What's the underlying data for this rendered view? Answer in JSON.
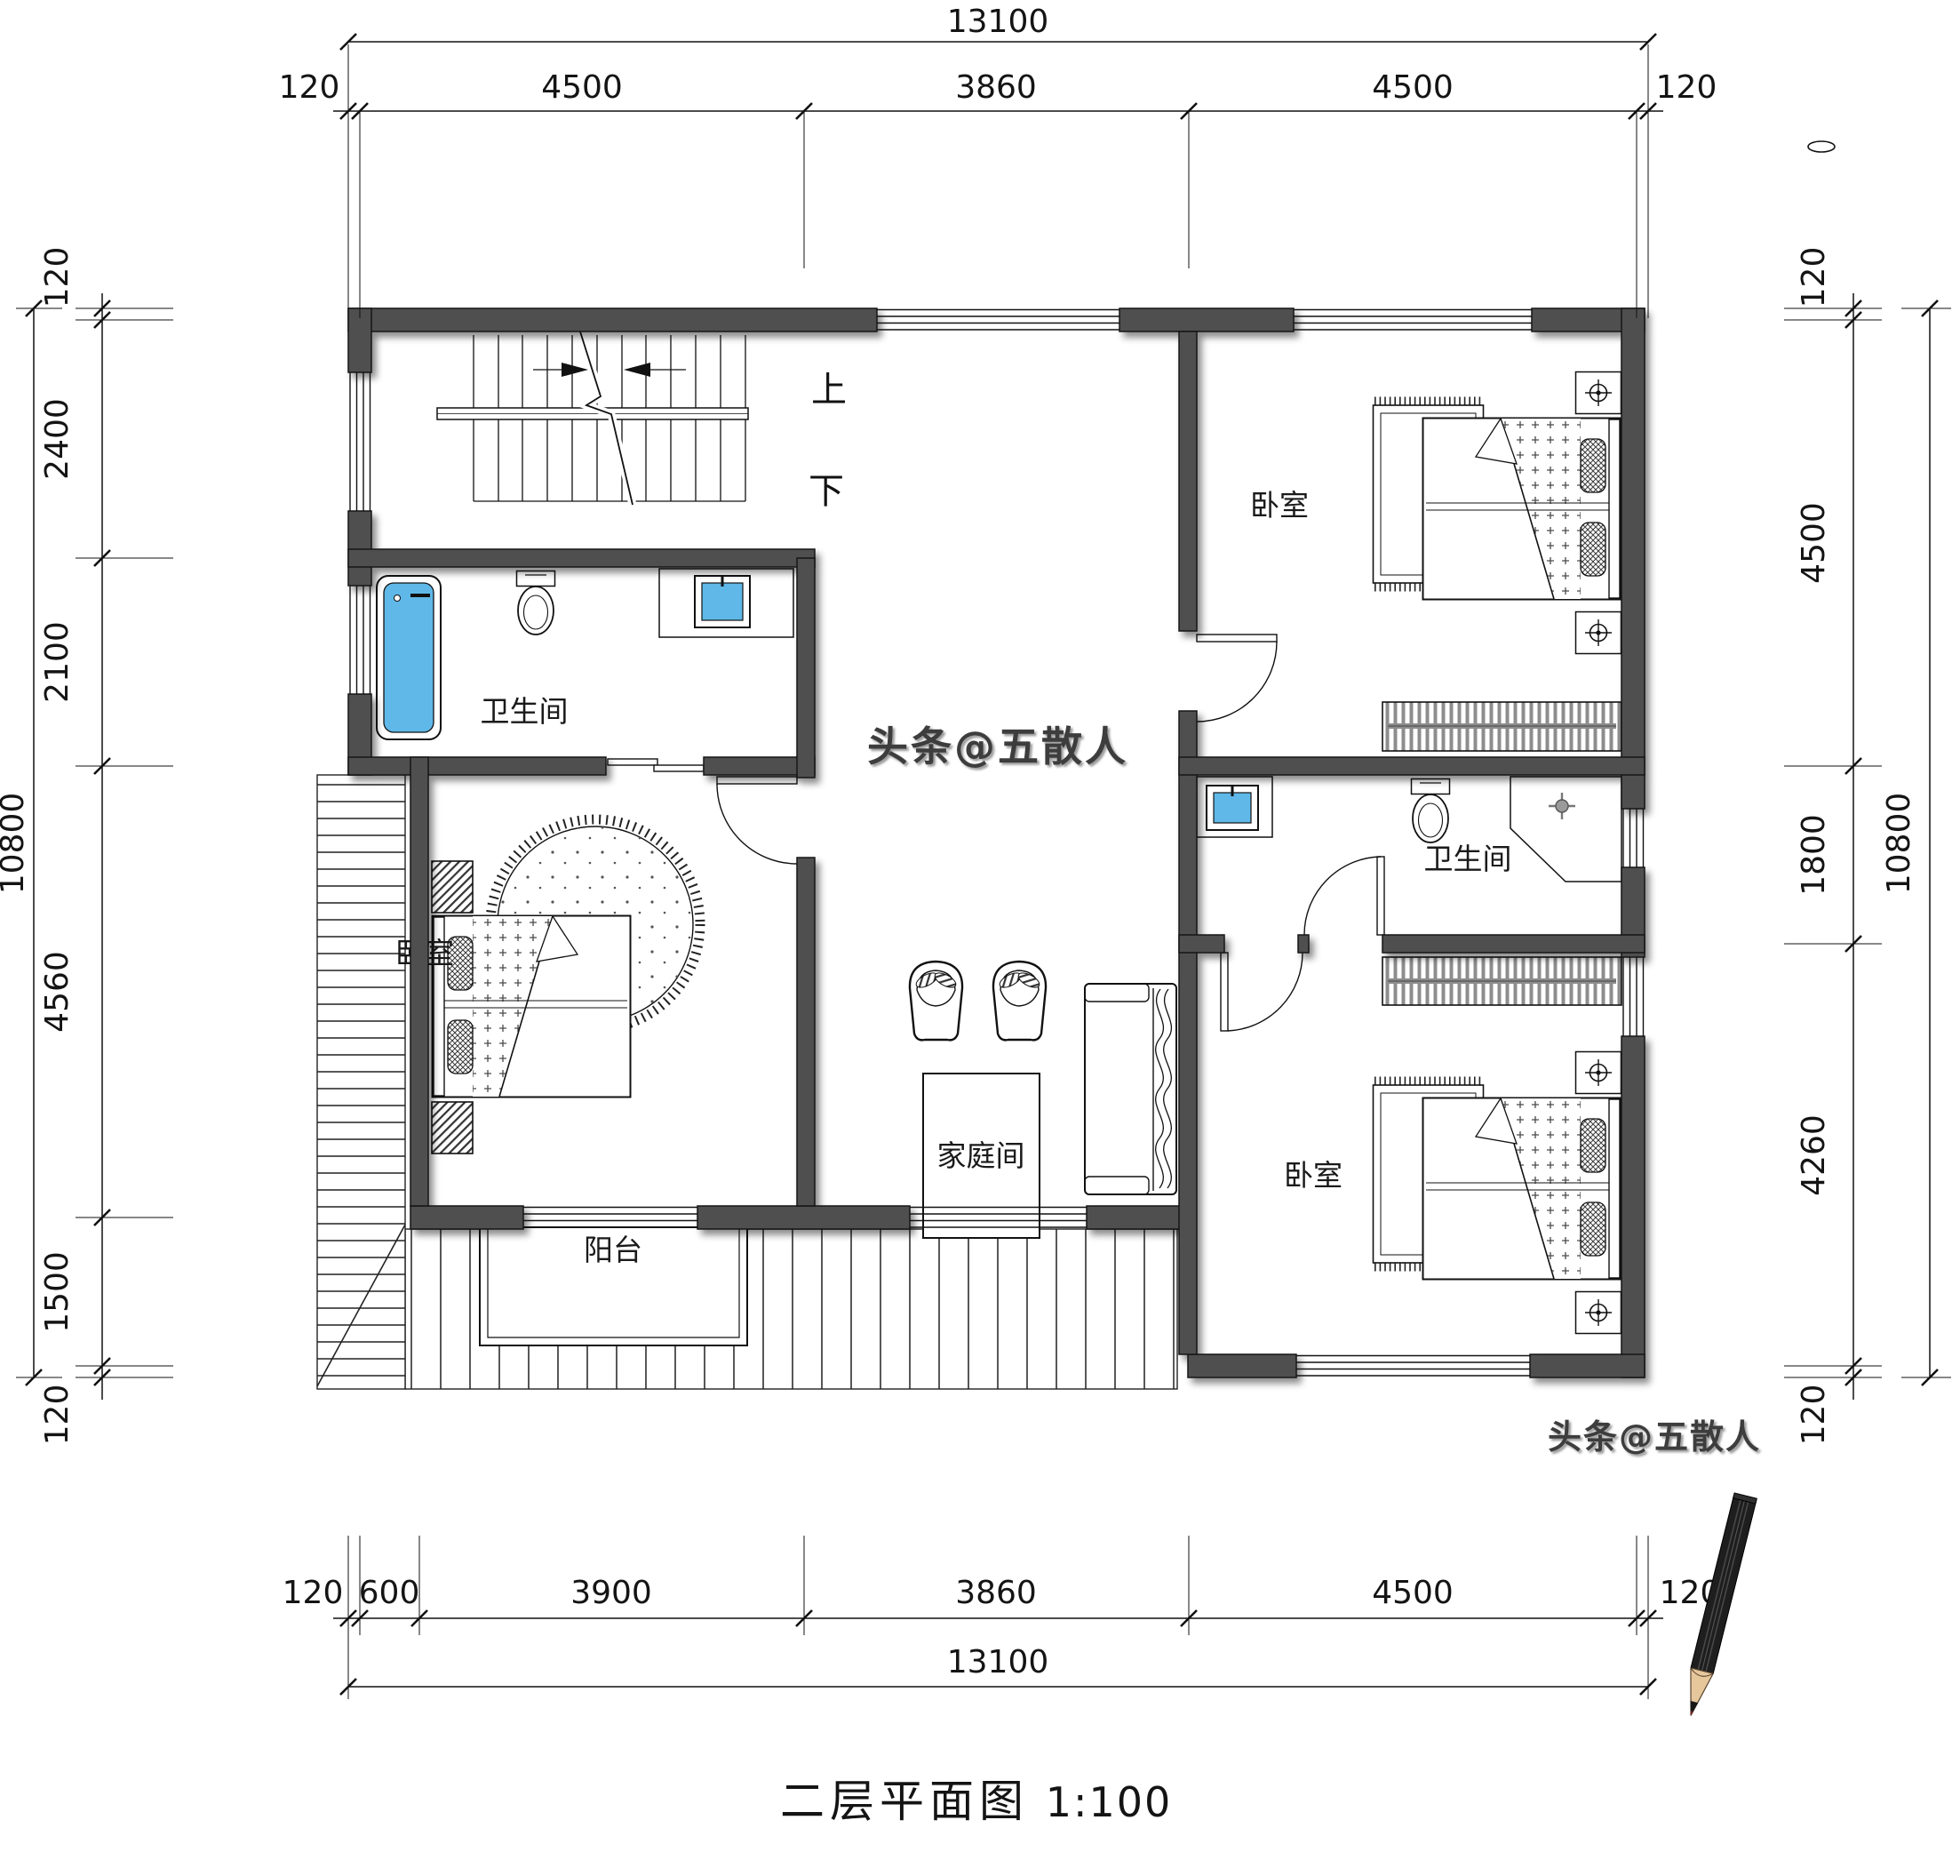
{
  "title": {
    "text": "二层平面图",
    "scale": "1:100"
  },
  "watermark": {
    "text": "头条@五散人"
  },
  "stairs": {
    "up_label": "上",
    "down_label": "下"
  },
  "rooms": {
    "bedroom_top_right": "卧室",
    "bedroom_left": "卧室",
    "bedroom_bottom_right": "卧室",
    "bathroom_left": "卫生间",
    "bathroom_right": "卫生间",
    "family_room": "家庭间",
    "balcony": "阳台"
  },
  "dims": {
    "top": {
      "overall": "13100",
      "segments": [
        "120",
        "4500",
        "3860",
        "4500",
        "120"
      ]
    },
    "bottom": {
      "overall": "13100",
      "segments": [
        "120",
        "600",
        "3900",
        "3860",
        "4500",
        "120"
      ]
    },
    "left": {
      "overall": "10800",
      "segments": [
        "120",
        "2400",
        "2100",
        "4560",
        "1500",
        "120"
      ]
    },
    "right": {
      "overall": "10800",
      "segments": [
        "120",
        "4500",
        "1800",
        "4260",
        "120"
      ]
    }
  },
  "colors": {
    "wall": "#4F4F4F",
    "fixture_blue": "#5FB8E8",
    "line": "#141414",
    "watermark_gray": "#3C3C3C"
  },
  "icons": {
    "lamp": "nightstand-lamp-icon",
    "shower": "shower-head-icon",
    "pencil": "pencil-graphic"
  }
}
